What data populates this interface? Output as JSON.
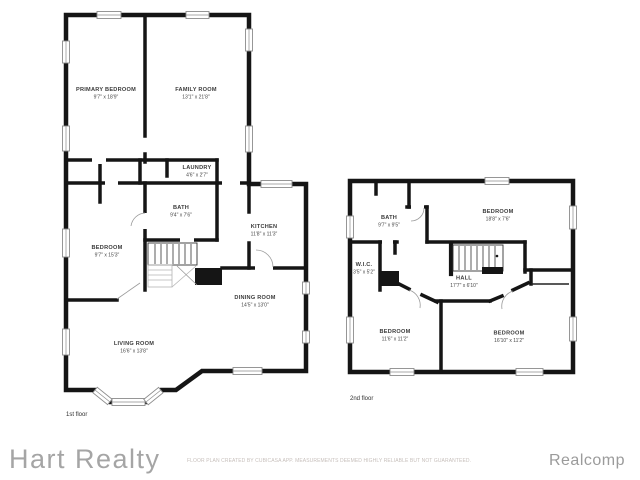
{
  "colors": {
    "wall": "#151515",
    "background": "#ffffff",
    "room_text": "#3a3a3a",
    "brand_text": "#a5a5a5",
    "disclaimer_text": "#c7bfbb",
    "attribution_text": "#9b9b9b"
  },
  "floors": [
    {
      "label": "1st floor",
      "rooms": [
        {
          "name": "PRIMARY BEDROOM",
          "dims": "9'7\" x 18'9\""
        },
        {
          "name": "FAMILY ROOM",
          "dims": "13'1\" x 21'8\""
        },
        {
          "name": "LAUNDRY",
          "dims": "4'6\" x 2'7\""
        },
        {
          "name": "BATH",
          "dims": "9'4\" x 7'6\""
        },
        {
          "name": "KITCHEN",
          "dims": "11'8\" x 11'3\""
        },
        {
          "name": "BEDROOM",
          "dims": "9'7\" x 15'3\""
        },
        {
          "name": "LIVING ROOM",
          "dims": "16'6\" x 13'8\""
        },
        {
          "name": "DINING ROOM",
          "dims": "14'5\" x 13'0\""
        }
      ]
    },
    {
      "label": "2nd floor",
      "rooms": [
        {
          "name": "BATH",
          "dims": "9'7\" x 9'5\""
        },
        {
          "name": "BEDROOM",
          "dims": "18'8\" x 7'6\""
        },
        {
          "name": "W.I.C.",
          "dims": "3'5\" x 5'2\""
        },
        {
          "name": "HALL",
          "dims": "17'7\" x 6'10\""
        },
        {
          "name": "BEDROOM",
          "dims": "11'6\" x 11'2\""
        },
        {
          "name": "BEDROOM",
          "dims": "16'10\" x 11'2\""
        }
      ]
    }
  ],
  "footer": {
    "brand": "Hart Realty",
    "disclaimer": "FLOOR PLAN CREATED BY CUBICASA APP. MEASUREMENTS DEEMED HIGHLY RELIABLE BUT NOT GUARANTEED.",
    "attribution": "Realcomp"
  }
}
